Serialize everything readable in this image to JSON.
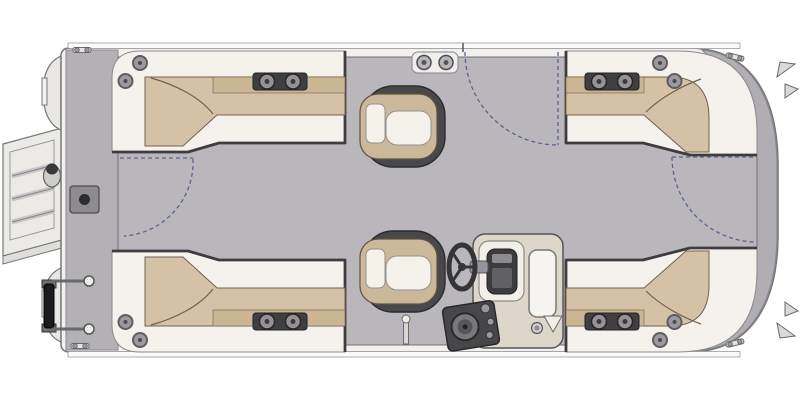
{
  "diagram": {
    "type": "pontoon-boat-floorplan-overhead",
    "orientation": {
      "bow": "right",
      "stern": "left"
    },
    "colors": {
      "background": "#ffffff",
      "hull_band": "#f3f1ee",
      "deck": "#b9b7bb",
      "bow_platform": "#b0aeb2",
      "stern_platform": "#b3b1b5",
      "seat_base": "#f5f2ed",
      "cushion_tan": "#d5c2a6",
      "cushion_tan_dark": "#cbb694",
      "trim_dark": "#3d3d3f",
      "chair_frame": "#48484a",
      "chair_tan": "#cbb89b",
      "chair_cushion": "#f5f2ec",
      "console_body": "#ddd6ca",
      "gate_dash": "#62628c",
      "hardware_gray": "#9a989d",
      "motor_black": "#1c1c1e"
    },
    "features": {
      "lounges": [
        "l-lounge-top-left",
        "l-lounge-top-right",
        "l-lounge-bottom-left",
        "l-lounge-bottom-right"
      ],
      "chairs": [
        "captain-chair-top",
        "helm-captain-chair"
      ],
      "helm": [
        "helm-console",
        "steering-wheel",
        "gauge-cluster",
        "windshield-panel",
        "speaker-dash-panel",
        "ski-pylon",
        "console-cup-holder"
      ],
      "gates": [
        "side-gate-top",
        "bow-gate-right",
        "stern-gate-left"
      ],
      "hardware": [
        "boarding-ladder",
        "stern-access-plate",
        "motor-mount-pins",
        "pontoon-stern-cones",
        "cleats",
        "bow-fins",
        "cup-holder-plates",
        "corner-speakers",
        "gate-hinge-plate"
      ]
    }
  }
}
